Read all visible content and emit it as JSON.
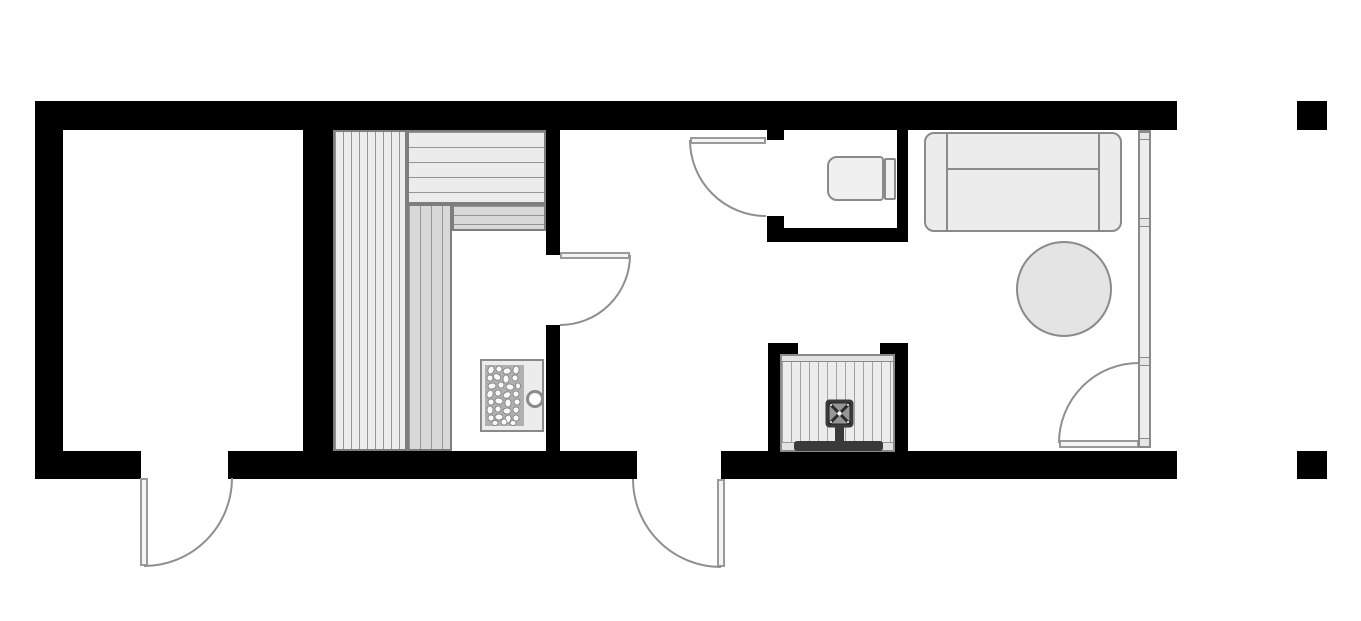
{
  "plan": {
    "type": "floor-plan",
    "colors": {
      "bg": "#ffffff",
      "wall": "#000000",
      "outline": "#8a8a8a",
      "bench_border": "#7e7e7e",
      "fill_light": "#ececec",
      "fill_mid": "#d8d8d8",
      "slat": "#959595",
      "door": "#9a9a9a",
      "arc": "#8f8f8f",
      "leaf_fill": "#f4f4f4",
      "stone_bg": "#b0b0b0",
      "stone": "#fbfbfb",
      "dark": "#3a3a3a",
      "table_fill": "#e4e4e4",
      "glass": "#ececec"
    },
    "objects": [
      "exterior-walls",
      "sauna-bench-upper-tier",
      "sauna-bench-lower-tier",
      "sauna-heater-with-stones",
      "hinged-door-sauna",
      "hinged-door-wc",
      "hinged-door-exit-left",
      "hinged-door-exit-middle",
      "hinged-glass-door",
      "toilet",
      "sofa",
      "round-table",
      "glazed-window-wall",
      "fireplace-with-flue",
      "terrace-posts"
    ]
  }
}
